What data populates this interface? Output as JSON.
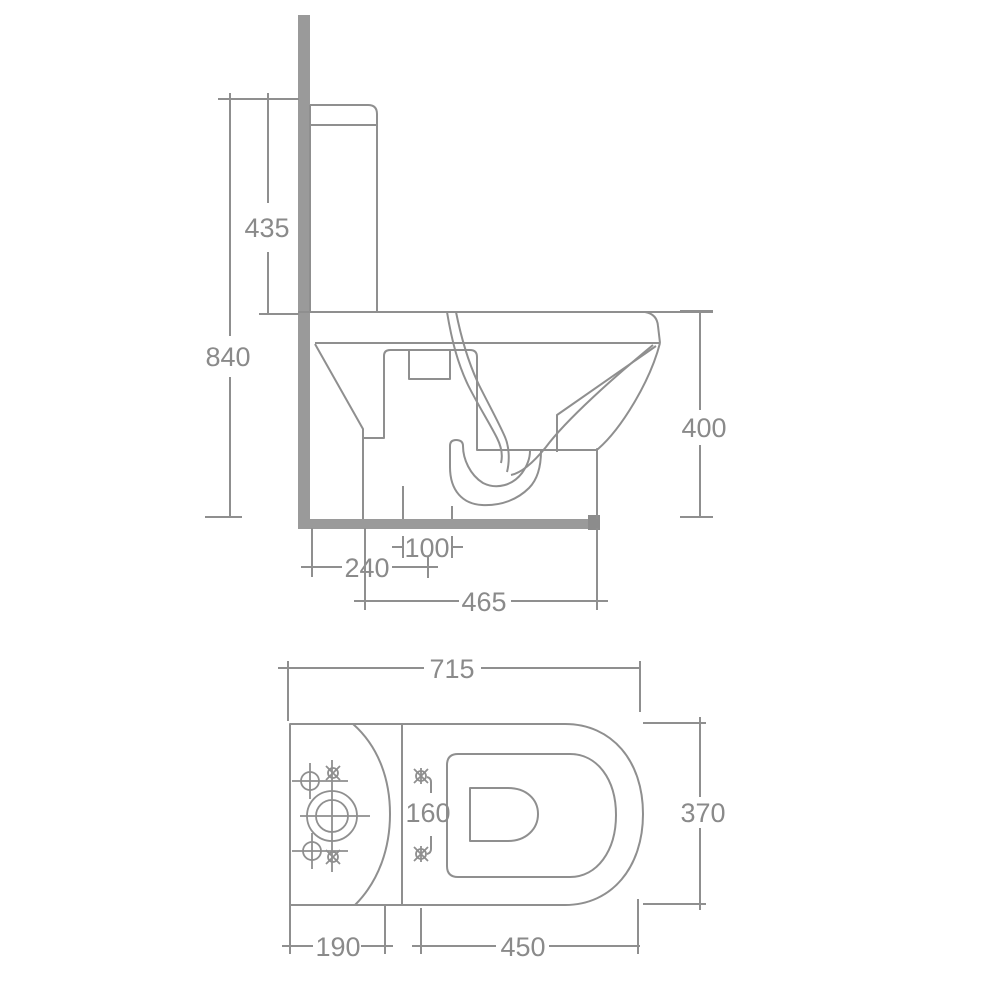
{
  "page": {
    "background": "#ffffff",
    "description": "Technical dimension drawing of a close-coupled toilet, side elevation and plan view"
  },
  "style": {
    "line_color": "#8f8f8f",
    "solid_fill_color": "#9a9a9a",
    "floor_cap_color": "#8c8c8c",
    "text_color": "#8a8a8a"
  },
  "side_view": {
    "dimensions": {
      "total_height": "840",
      "cistern_height": "435",
      "bowl_height": "400",
      "outlet_width": "100",
      "outlet_setout": "240",
      "base_depth": "465"
    }
  },
  "plan_view": {
    "dimensions": {
      "overall_depth": "715",
      "overall_width": "370",
      "cistern_depth": "190",
      "bowl_length": "450",
      "fixing_hole_centres": "160"
    }
  }
}
